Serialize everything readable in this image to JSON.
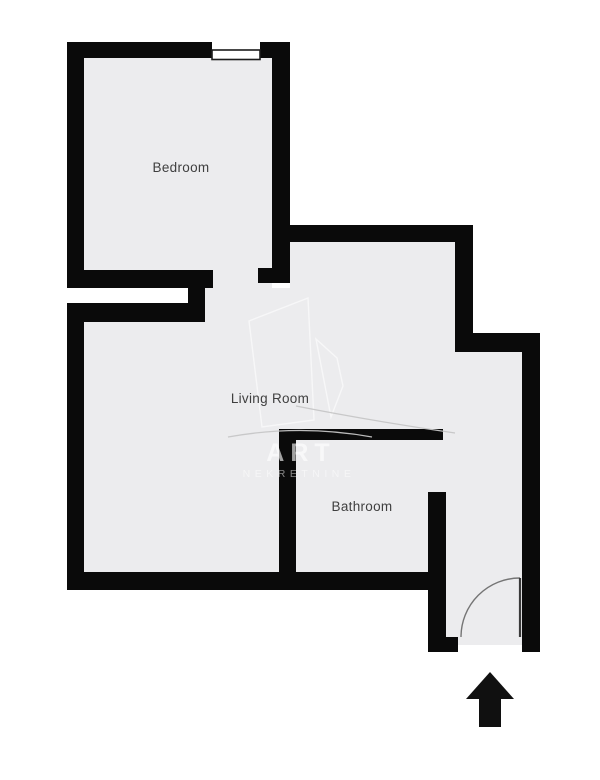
{
  "document": {
    "type": "apartment-floor-plan",
    "description": "Black-and-white one-bedroom apartment floor plan with agency watermark"
  },
  "rooms": [
    {
      "label": "Bedroom"
    },
    {
      "label": "Living Room"
    },
    {
      "label": "Bathroom"
    }
  ],
  "watermark": {
    "brand": "ART",
    "subtitle": "NEKRETNINE"
  },
  "entrance": {
    "arrow_direction": "up",
    "door_symbol": "quarter-circle swing arc"
  },
  "features": {
    "windows": 1,
    "bedroom_doorway": "open passage",
    "bathroom_doorway": "open passage"
  },
  "colors": {
    "wall": "#0a0a0a",
    "floor": "#ececee",
    "background": "#ffffff",
    "label_text": "#3f3f3f",
    "arrow": "#101010"
  }
}
